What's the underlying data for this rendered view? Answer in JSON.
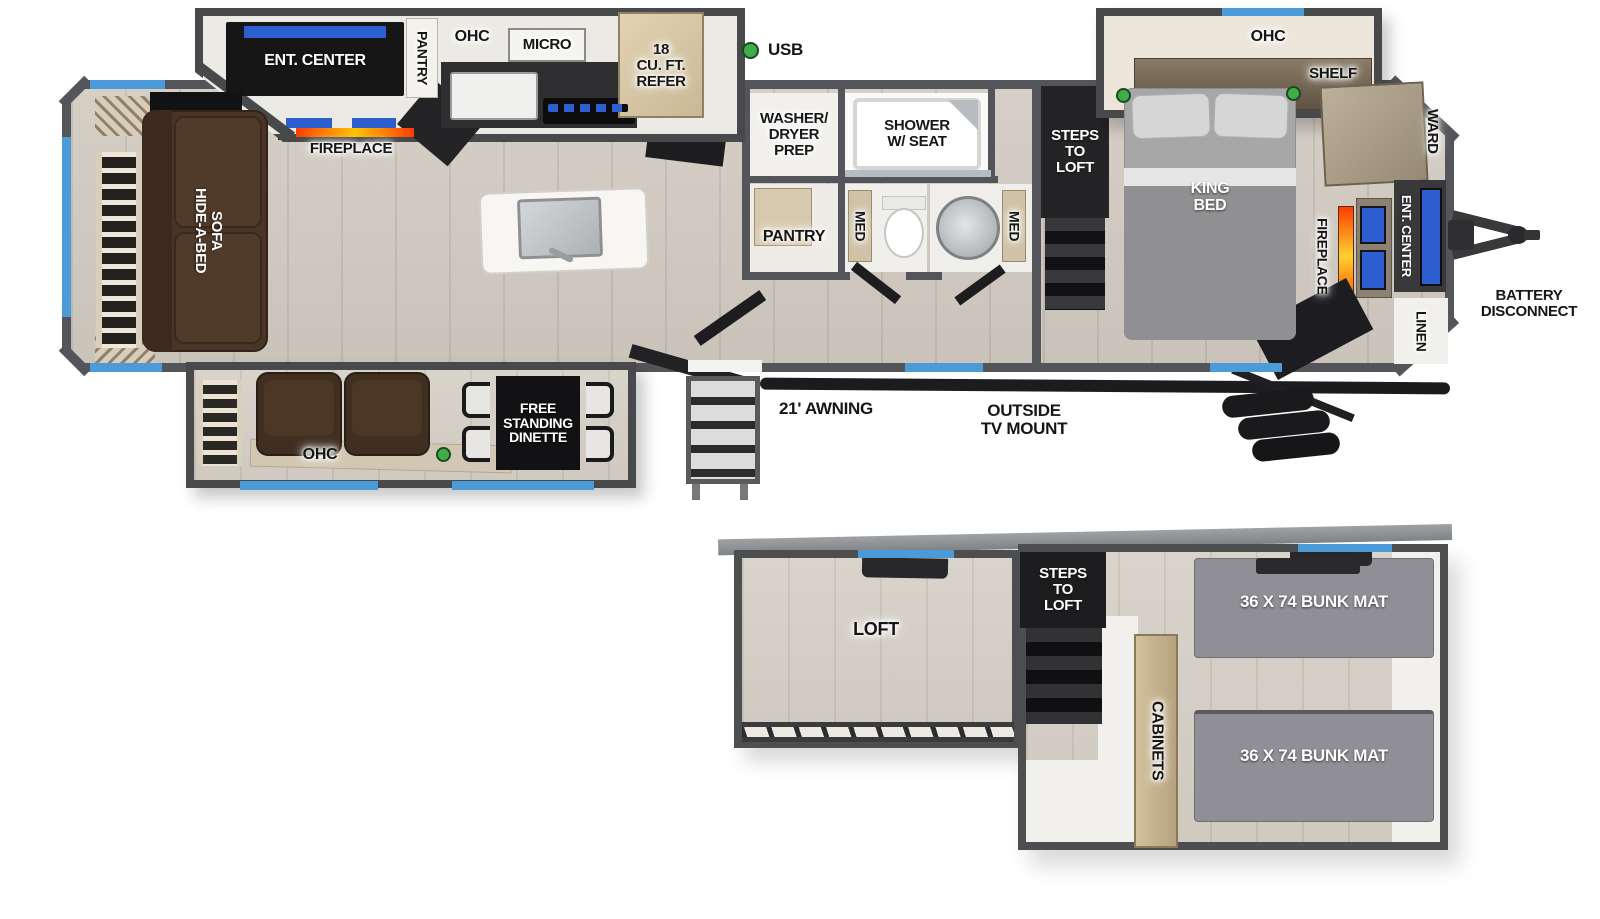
{
  "colors": {
    "wall": "#54555a",
    "slide_wall": "#48494b",
    "floor_wood": "#d2ccc3",
    "window_blue": "#4a9bd8",
    "usb_green": "#3fae49",
    "tv_blue": "#2d5fd0",
    "fireplace_orange": "#ff5a00",
    "sofa_brown": "#4a3426",
    "mat_gray": "#8f8f95"
  },
  "legend": {
    "usb": "USB"
  },
  "main_plan": {
    "kitchen_slide": {
      "ent_center": "ENT. CENTER",
      "pantry": "PANTRY",
      "ohc": "OHC",
      "micro": "MICRO",
      "fireplace": "FIREPLACE"
    },
    "kitchen": {
      "refer": "18\nCU. FT.\nREFER"
    },
    "living": {
      "sofa": "HIDE-A-BED\nSOFA"
    },
    "bath": {
      "washer_dryer": "WASHER/\nDRYER\nPREP",
      "shower": "SHOWER\nW/ SEAT",
      "pantry": "PANTRY",
      "med_left": "MED",
      "med_right": "MED"
    },
    "steps_to_loft": "STEPS\nTO\nLOFT",
    "bedroom": {
      "ohc": "OHC",
      "shelf": "SHELF",
      "king_bed": "KING\nBED",
      "ward": "WARD",
      "fireplace": "FIREPLACE",
      "ent_center": "ENT. CENTER",
      "linen": "LINEN"
    },
    "exterior": {
      "battery_disconnect": "BATTERY\nDISCONNECT",
      "awning": "21' AWNING",
      "tv_mount": "OUTSIDE\nTV MOUNT"
    },
    "door_slide": {
      "ohc": "OHC",
      "dinette": "FREE\nSTANDING\nDINETTE"
    }
  },
  "loft_plan": {
    "loft": "LOFT",
    "steps_to_loft": "STEPS\nTO\nLOFT",
    "cabinets": "CABINETS",
    "bunk_top": "36 X 74 BUNK MAT",
    "bunk_bottom": "36 X 74 BUNK MAT"
  }
}
